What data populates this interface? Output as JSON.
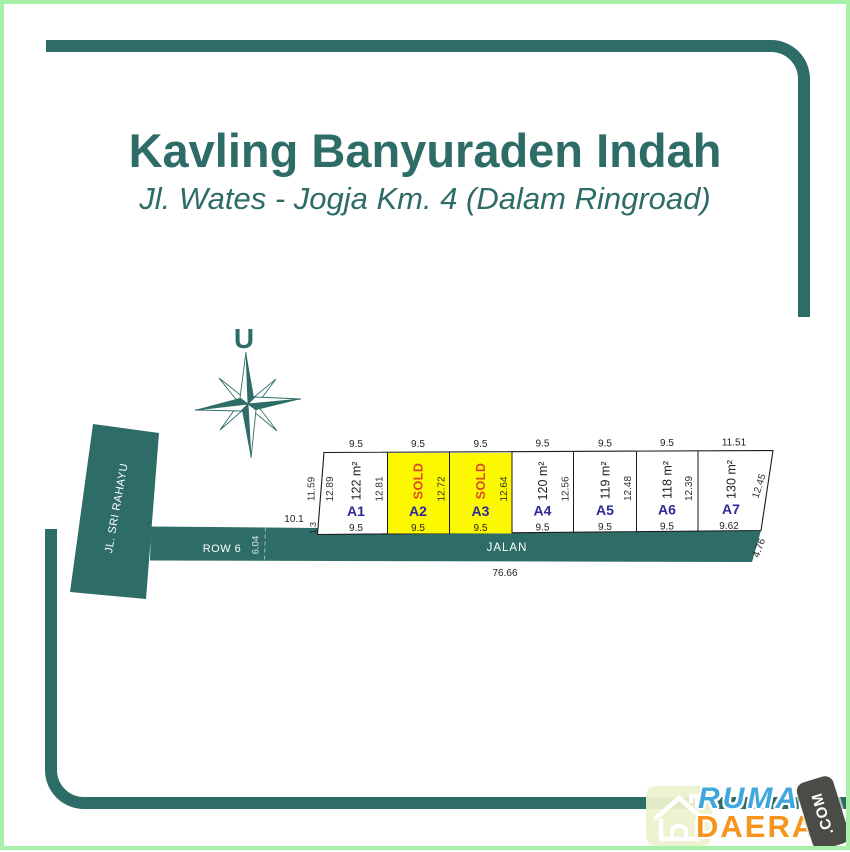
{
  "title": "Kavling Banyuraden Indah",
  "subtitle": "Jl. Wates - Jogja Km. 4 (Dalam Ringroad)",
  "compass": {
    "north_label": "U"
  },
  "roads": {
    "side_road_name": "JL. SRI RAHAYU",
    "row_label": "ROW 6",
    "main_road_name": "JALAN",
    "main_road_length": "76.66",
    "row_width": "6.04",
    "frontage_left": "10.1",
    "corner_offset": "1.3",
    "end_width": "4.76"
  },
  "block_left_dims": {
    "outer": "11.59",
    "inner": "12.89"
  },
  "plots": [
    {
      "id": "A1",
      "label": "122 m²",
      "top": "9.5",
      "bottom": "9.5",
      "side": "12.81",
      "status": "available"
    },
    {
      "id": "A2",
      "label": "SOLD",
      "top": "9.5",
      "bottom": "9.5",
      "side": "12.72",
      "status": "sold"
    },
    {
      "id": "A3",
      "label": "SOLD",
      "top": "9.5",
      "bottom": "9.5",
      "side": "12.64",
      "status": "sold"
    },
    {
      "id": "A4",
      "label": "120 m²",
      "top": "9.5",
      "bottom": "9.5",
      "side": "12.56",
      "status": "available"
    },
    {
      "id": "A5",
      "label": "119 m²",
      "top": "9.5",
      "bottom": "9.5",
      "side": "12.48",
      "status": "available"
    },
    {
      "id": "A6",
      "label": "118 m²",
      "top": "9.5",
      "bottom": "9.5",
      "side": "12.39",
      "status": "available"
    },
    {
      "id": "A7",
      "label": "130 m²",
      "top": "11.51",
      "bottom": "9.62",
      "side": "12.45",
      "status": "available"
    }
  ],
  "watermark": {
    "word1": "RUMAH",
    "word2": "DAERAH",
    "domain_suffix": ".COM"
  },
  "colors": {
    "teal": "#2E6C67",
    "sold_fill": "#FCF800",
    "sold_text": "#D9472B",
    "plot_id_text": "#2B2A97",
    "watermark_blue": "#3FA7DE",
    "watermark_orange": "#F6941D",
    "outer_border_green": "#A7F0A7"
  }
}
